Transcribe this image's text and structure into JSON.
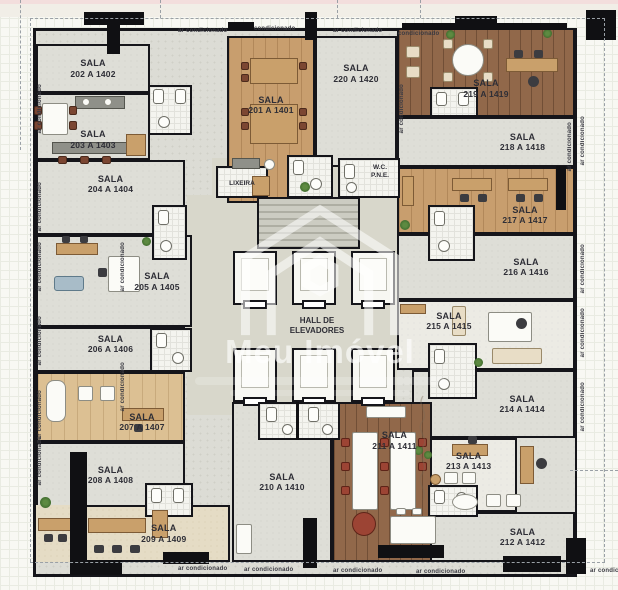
{
  "labels": {
    "sala": "SALA",
    "ac": "ar condicionado",
    "lixeira": "LIXEIRA",
    "wc_line1": "W.C.",
    "wc_line2": "P.N.E.",
    "hall_line1": "HALL DE",
    "hall_line2": "ELEVADORES"
  },
  "watermark": {
    "brand": "Meu Imóvel"
  },
  "rooms": [
    {
      "code": "201 A 1401"
    },
    {
      "code": "202 A 1402"
    },
    {
      "code": "203 A 1403"
    },
    {
      "code": "204 A 1404"
    },
    {
      "code": "205 A 1405"
    },
    {
      "code": "206 A 1406"
    },
    {
      "code": "207 A 1407"
    },
    {
      "code": "208 A 1408"
    },
    {
      "code": "209 A 1409"
    },
    {
      "code": "210 A 1410"
    },
    {
      "code": "211 A 1411"
    },
    {
      "code": "212 A 1412"
    },
    {
      "code": "213 A 1413"
    },
    {
      "code": "214 A 1414"
    },
    {
      "code": "215 A 1415"
    },
    {
      "code": "216 A 1416"
    },
    {
      "code": "217 A 1417"
    },
    {
      "code": "218 A 1418"
    },
    {
      "code": "219 A 1419"
    },
    {
      "code": "220 A 1420"
    }
  ],
  "colors": {
    "wall": "#15151a",
    "carpet": "#deded7",
    "wood_light": "#dcc093",
    "wood_mid": "#c89e6e",
    "wood_dark": "#91684a",
    "beige": "#e5dcc5",
    "label_text": "#2e2e36"
  }
}
